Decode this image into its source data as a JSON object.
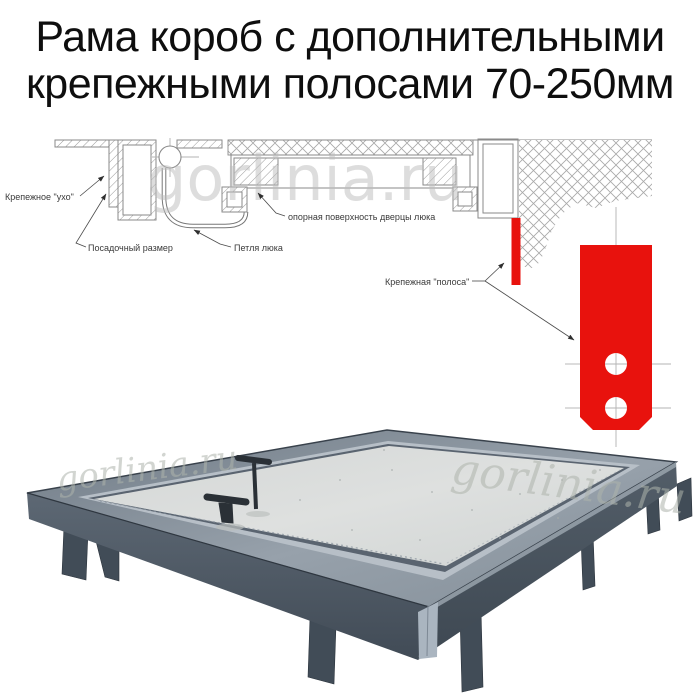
{
  "title": {
    "line1": "Рама короб с дополнительными",
    "line2": "крепежными полосами 70-250мм"
  },
  "diagram": {
    "labels": {
      "ear": "Крепежное \"ухо\"",
      "mounting_size": "Посадочный размер",
      "hinge": "Петля люка",
      "support_surface": "опорная поверхность дверцы люка",
      "strip": "Крепежная \"полоса\""
    }
  },
  "watermark": {
    "text": "gorlinia.ru"
  },
  "colors": {
    "accent_red": "#e8120d",
    "steel_dark": "#47525d",
    "steel_light": "#9aa4ad",
    "panel_gray": "#dadcdb",
    "line_gray": "#8a8a8a"
  }
}
